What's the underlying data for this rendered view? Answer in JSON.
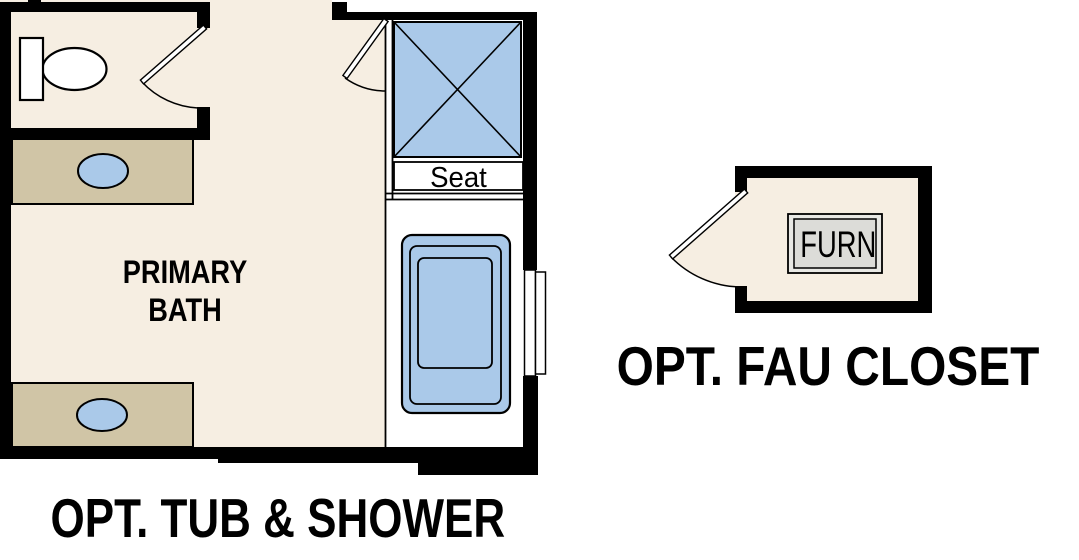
{
  "diagram": {
    "type": "architectural floor plan",
    "background": "#ffffff",
    "colors": {
      "wall": "#000000",
      "floor": "#f6eee2",
      "counter": "#d0c5a6",
      "fixture_blue": "#aac9e9",
      "alcove_floor": "#ffffff",
      "furnace_outer": "#e8e8e4",
      "furnace_inner": "#dcdcd8",
      "line": "#000000",
      "text": "#000000"
    },
    "primary_bath": {
      "name_line1": "PRIMARY",
      "name_line2": "BATH",
      "caption": "OPT. TUB & SHOWER",
      "shower_seat": "Seat",
      "fixtures": [
        "toilet",
        "vanity sink (upper)",
        "vanity sink (lower)",
        "shower with seat",
        "bathtub",
        "window",
        "water-closet door",
        "shower door"
      ]
    },
    "fau_closet": {
      "caption": "OPT. FAU CLOSET",
      "furnace": "FURN",
      "fixtures": [
        "furnace unit",
        "closet door"
      ]
    }
  }
}
